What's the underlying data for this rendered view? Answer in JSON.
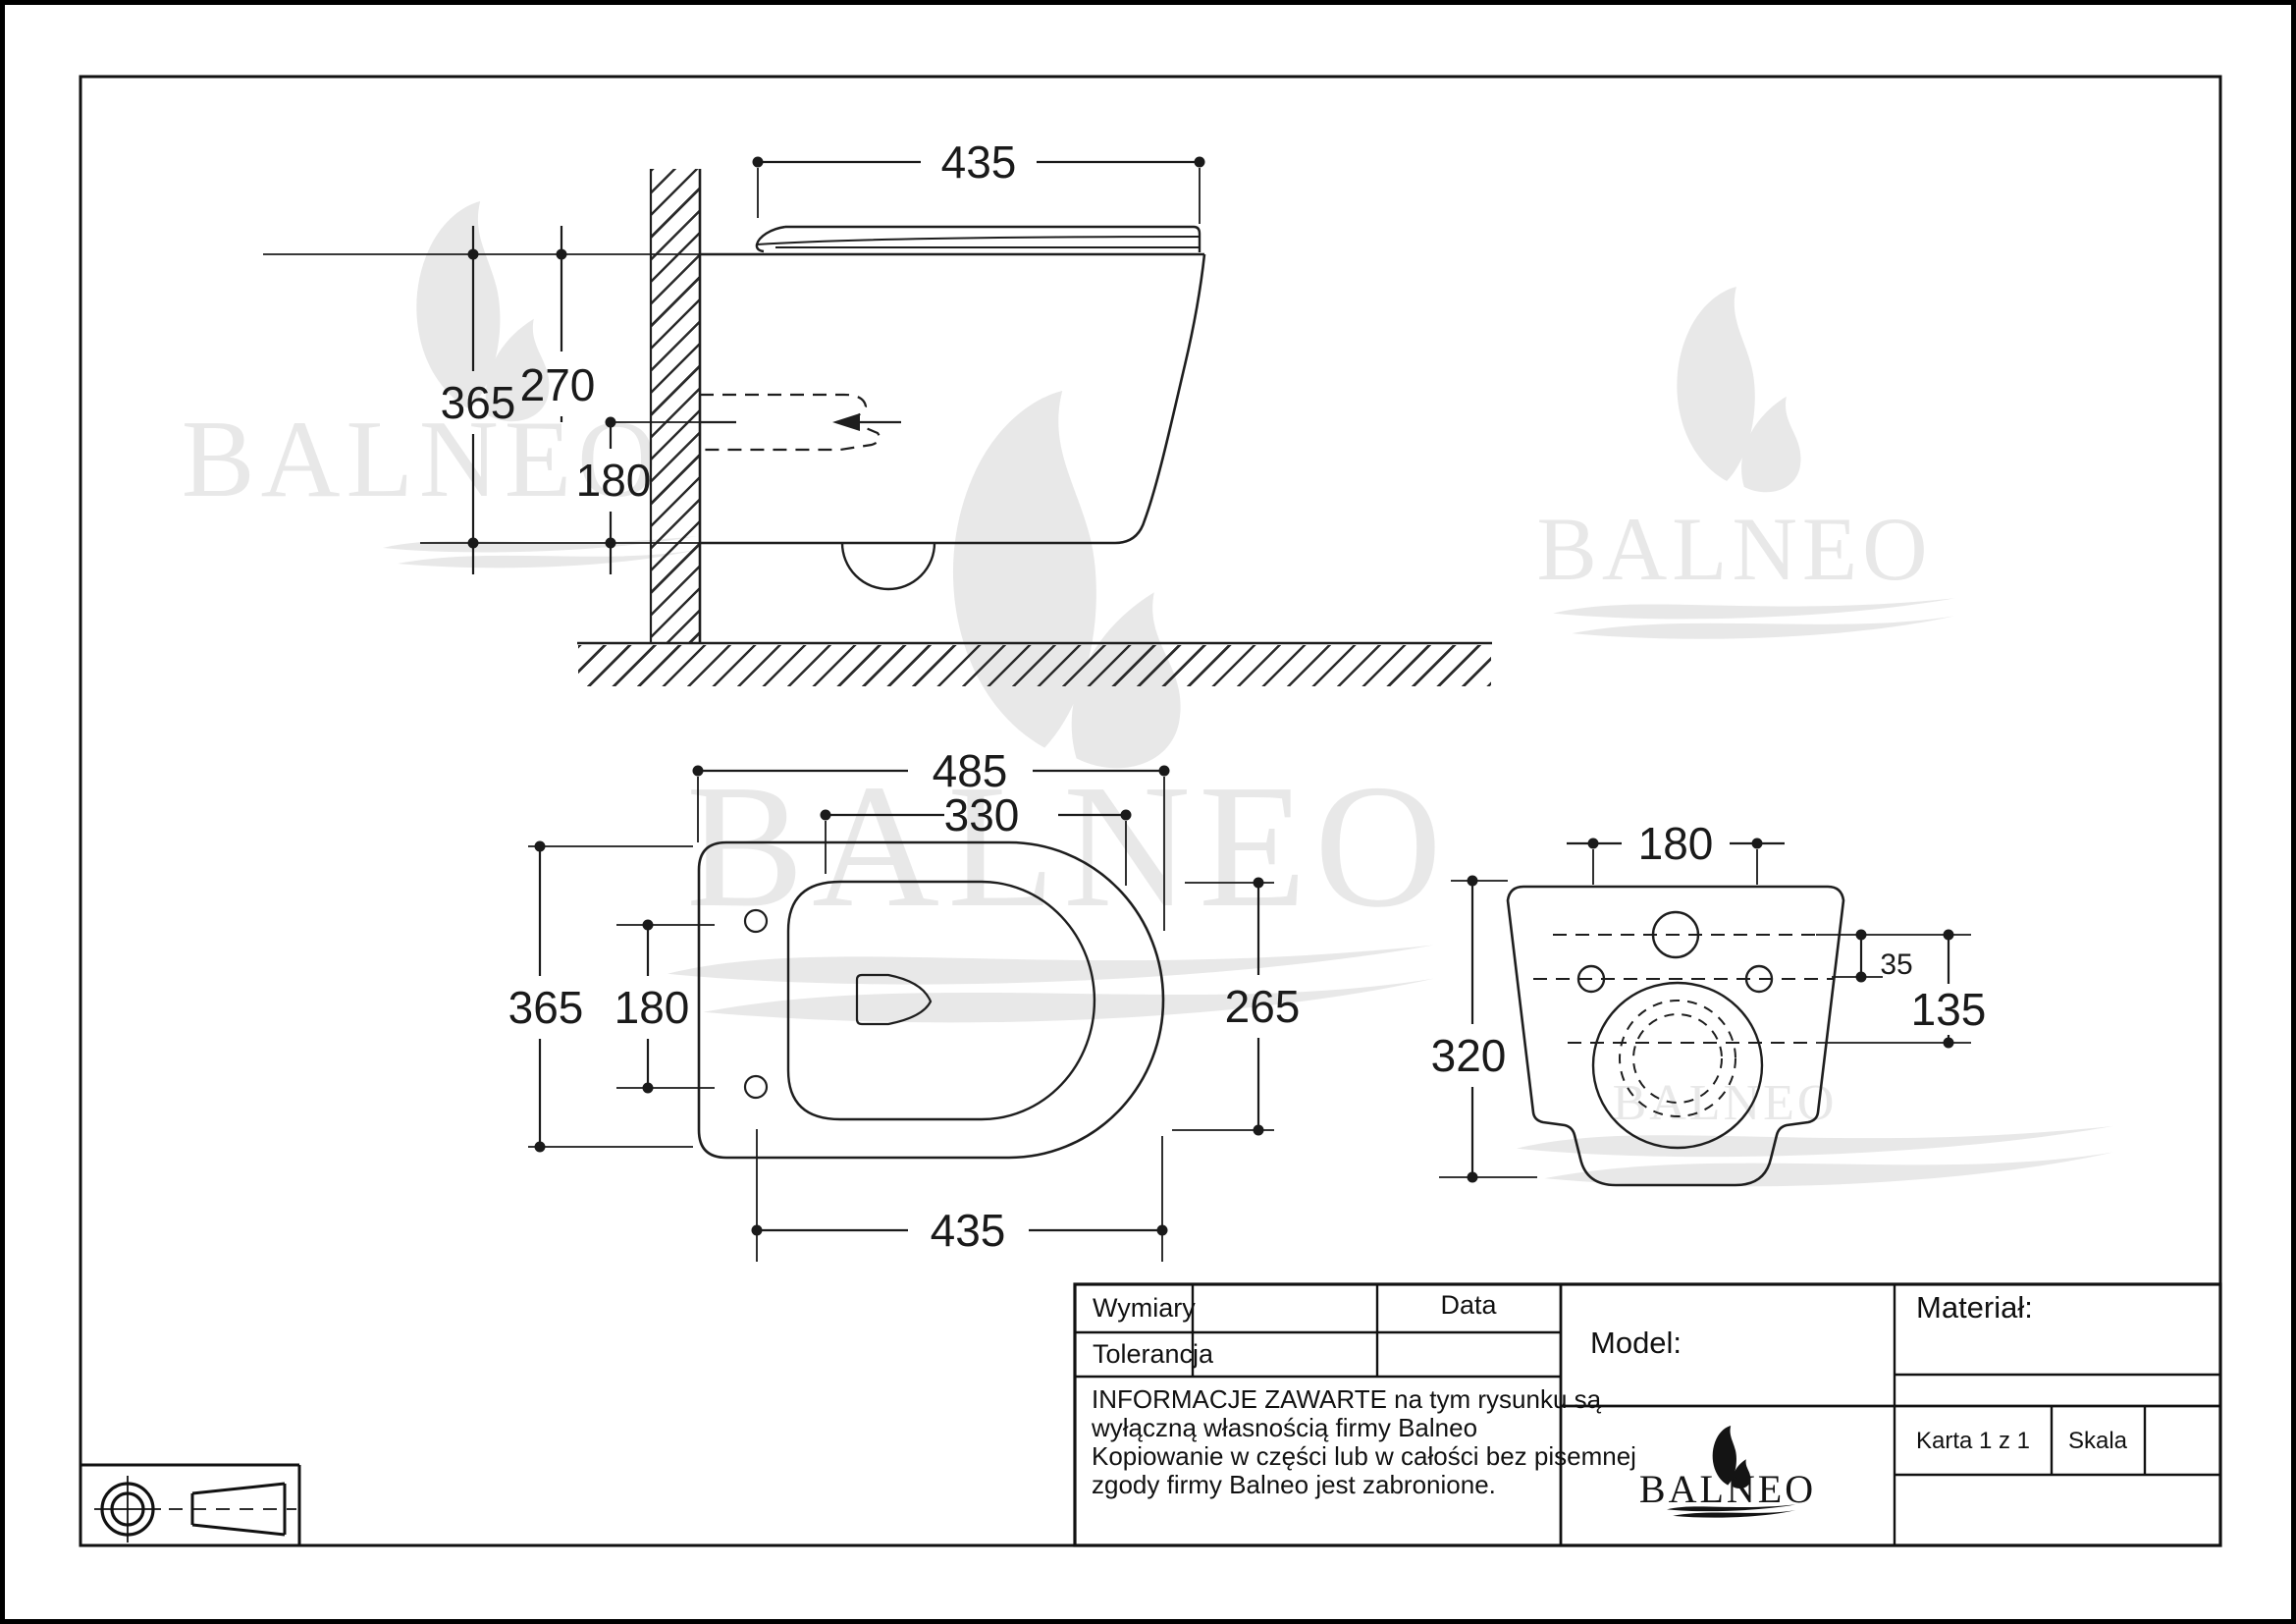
{
  "brand": {
    "name": "BALNEO"
  },
  "side_view": {
    "dim_top_width": "435",
    "dim_height": "365",
    "dim_inlet": "270",
    "dim_outlet": "180"
  },
  "plan_view": {
    "dim_length": "485",
    "dim_inner_length": "330",
    "dim_width": "365",
    "dim_hole_spacing": "180",
    "dim_right": "265",
    "dim_bottom_length": "435"
  },
  "rear_view": {
    "dim_hole_spacing": "180",
    "dim_offset": "35",
    "dim_height_right": "135",
    "dim_height_left": "320"
  },
  "title_block": {
    "wymiary_label": "Wymiary",
    "tolerancja_label": "Tolerancja",
    "data_label": "Data",
    "model_label": "Model:",
    "material_label": "Materiał:",
    "karta_label": "Karta 1 z 1",
    "skala_label": "Skala",
    "info_lines": [
      "INFORMACJE ZAWARTE na tym rysunku są",
      "wyłączną własnością firmy Balneo",
      "Kopiowanie w części lub w całości bez pisemnej",
      "zgody firmy Balneo jest zabronione."
    ]
  }
}
